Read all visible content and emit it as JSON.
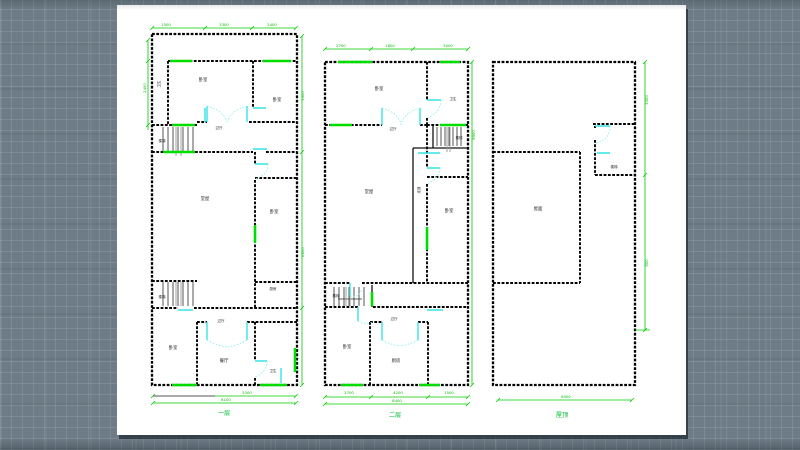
{
  "window": {
    "background_color": "#6e7c87",
    "paper_color": "#ffffff"
  },
  "drawing": {
    "colors": {
      "wall": "#000000",
      "window_marker": "#00dd00",
      "door_marker": "#35e4e6",
      "dimension": "#00cc00",
      "stair": "#2b2b2b",
      "room_label": "#1c1c1c",
      "caption": "#00bb33"
    },
    "plans": [
      {
        "name": "first-floor-plan",
        "caption": "一层",
        "rooms": [
          "卧室",
          "卧室",
          "卫生",
          "过厅",
          "楼梯",
          "堂屋",
          "卧室",
          "厨房",
          "楼梯",
          "过厅",
          "卧室",
          "餐厅",
          "卫生"
        ],
        "dims_top": [
          "1500",
          "3300",
          "2400"
        ],
        "dims_right": [
          "3300",
          "6600"
        ],
        "dims_left": [
          "2400"
        ],
        "dims_bottom": [
          "3300",
          "8100"
        ]
      },
      {
        "name": "second-floor-plan",
        "caption": "二层",
        "rooms": [
          "卧室",
          "卫生",
          "过厅",
          "楼梯",
          "堂屋",
          "走道",
          "卧室",
          "楼梯",
          "过厅",
          "卧室",
          "厨房"
        ],
        "dims_top": [
          "2700",
          "1800",
          "3000"
        ],
        "dims_right": [
          "9900"
        ],
        "dims_bottom": [
          "2700",
          "4200",
          "1500",
          "8400"
        ]
      },
      {
        "name": "roof-plan",
        "caption": "屋顶",
        "rooms": [
          "楼梯",
          "屋面"
        ],
        "dims_right": [
          "3300",
          "900"
        ],
        "dims_bottom": [
          "6000"
        ]
      }
    ]
  }
}
